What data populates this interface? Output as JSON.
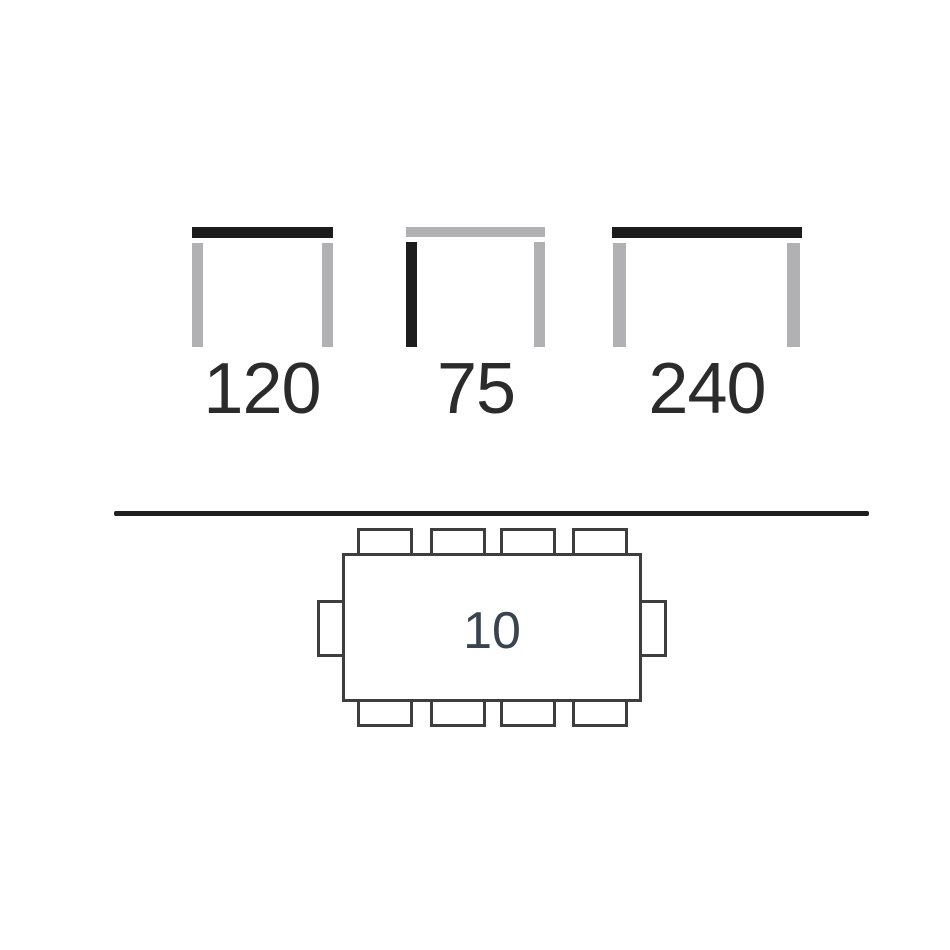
{
  "dimension_diagrams": [
    {
      "name": "table-width",
      "value": "120",
      "highlighted_part": "tabletop",
      "bar_color": "#1c1c1c",
      "leg_color": "#b1b1b3"
    },
    {
      "name": "table-height",
      "value": "75",
      "highlighted_part": "left-leg",
      "bar_color": "#b1b1b3",
      "leg_color": "#1c1c1c"
    },
    {
      "name": "table-width-extended",
      "value": "240",
      "highlighted_part": "tabletop",
      "bar_color": "#1c1c1c",
      "leg_color": "#b1b1b3"
    }
  ],
  "seating_plan": {
    "capacity": "10",
    "chairs_top": 4,
    "chairs_bottom": 4,
    "chairs_left": 1,
    "chairs_right": 1,
    "outline_color": "#3e3e3e",
    "capacity_text_color": "#3a4450"
  },
  "colors": {
    "background": "#ffffff",
    "highlight_dark": "#1c1c1c",
    "neutral_gray": "#b1b1b3",
    "divider": "#1f1f1f",
    "dimension_text": "#2b2b2b"
  }
}
